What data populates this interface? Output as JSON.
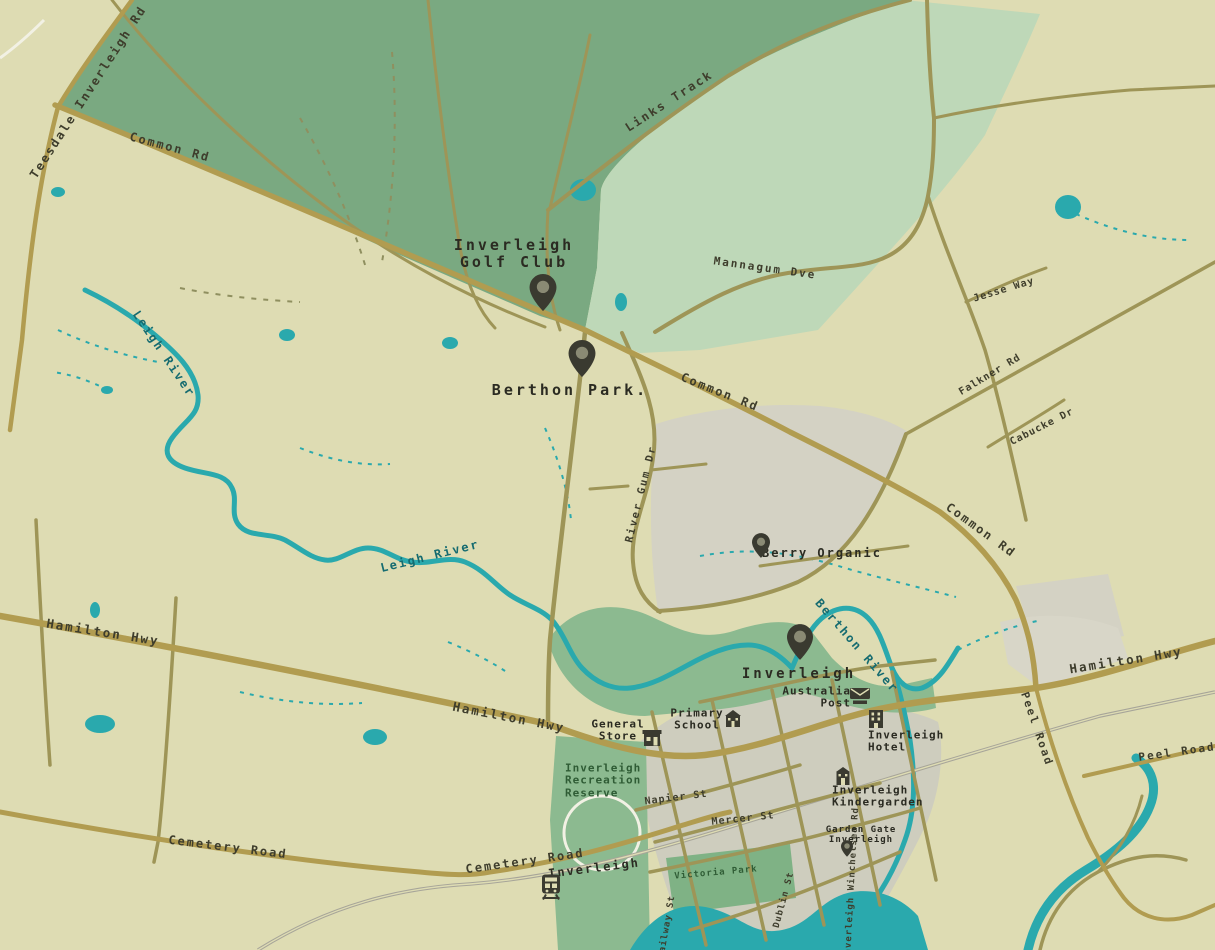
{
  "map": {
    "title": "Inverleigh area map",
    "colors": {
      "background": "#dedcb3",
      "forest_green": "#7aa981",
      "golf_light_green": "#bed8b8",
      "parkland_green": "#8cba90",
      "urban_grey": "#cecdbe",
      "patch_grey": "#d4d2c4",
      "water_teal": "#2aa9ad",
      "road_major": "#b19c50",
      "road_minor": "#9e9557",
      "railway_grey": "#a7a599",
      "label_dark": "#3e3d2c",
      "label_water": "#156b70",
      "label_green": "#2f5c35",
      "pin_dark": "#3a3a30"
    },
    "road_labels": {
      "teesdale": "Teesdale Inverleigh Rd",
      "common1": "Common Rd",
      "links": "Links Track",
      "mannagum": "Mannagum Dve",
      "common2": "Common Rd",
      "jesse": "Jesse Way",
      "falkner": "Falkner Rd",
      "cabucke": "Cabucke Dr",
      "rivergum": "River Gum Dr",
      "common3": "Common Rd",
      "hamilton1": "Hamilton Hwy",
      "hamilton2": "Hamilton Hwy",
      "hamilton3": "Hamilton Hwy",
      "peel_v": "Peel Road",
      "peel_h": "Peel Road",
      "cemetery1": "Cemetery Road",
      "cemetery2": "Cemetery Road",
      "napier": "Napier St",
      "mercer": "Mercer St",
      "railway_st": "Railway St",
      "dublin": "Dublin St",
      "winchelsea": "Inverleigh Winchelsea Rd"
    },
    "water_labels": {
      "leigh1": "Leigh River",
      "leigh2": "Leigh River",
      "berthon": "Berthon River"
    },
    "poi": {
      "golf": [
        "Inverleigh",
        "Golf Club"
      ],
      "berthon_park": "Berthon Park.",
      "berry": "Berry Organic",
      "town": "Inverleigh",
      "post": [
        "Australia",
        "Post"
      ],
      "school": [
        "Primary",
        "School"
      ],
      "store": [
        "General",
        "Store"
      ],
      "hotel": [
        "Inverleigh",
        "Hotel"
      ],
      "reserve": [
        "Inverleigh",
        "Recreation",
        "Reserve"
      ],
      "kinder": [
        "Inverleigh",
        "Kindergarden"
      ],
      "garden_gate": [
        "Garden Gate",
        "Inverleigh"
      ],
      "station": "Inverleigh",
      "victoria": "Victoria Park"
    },
    "icons": {
      "pin": "map-pin",
      "station": "train-station",
      "post": "post-office-building",
      "school": "school-building",
      "store": "general-store-building",
      "hotel": "hotel-building",
      "kinder": "kindergarten-building"
    }
  }
}
